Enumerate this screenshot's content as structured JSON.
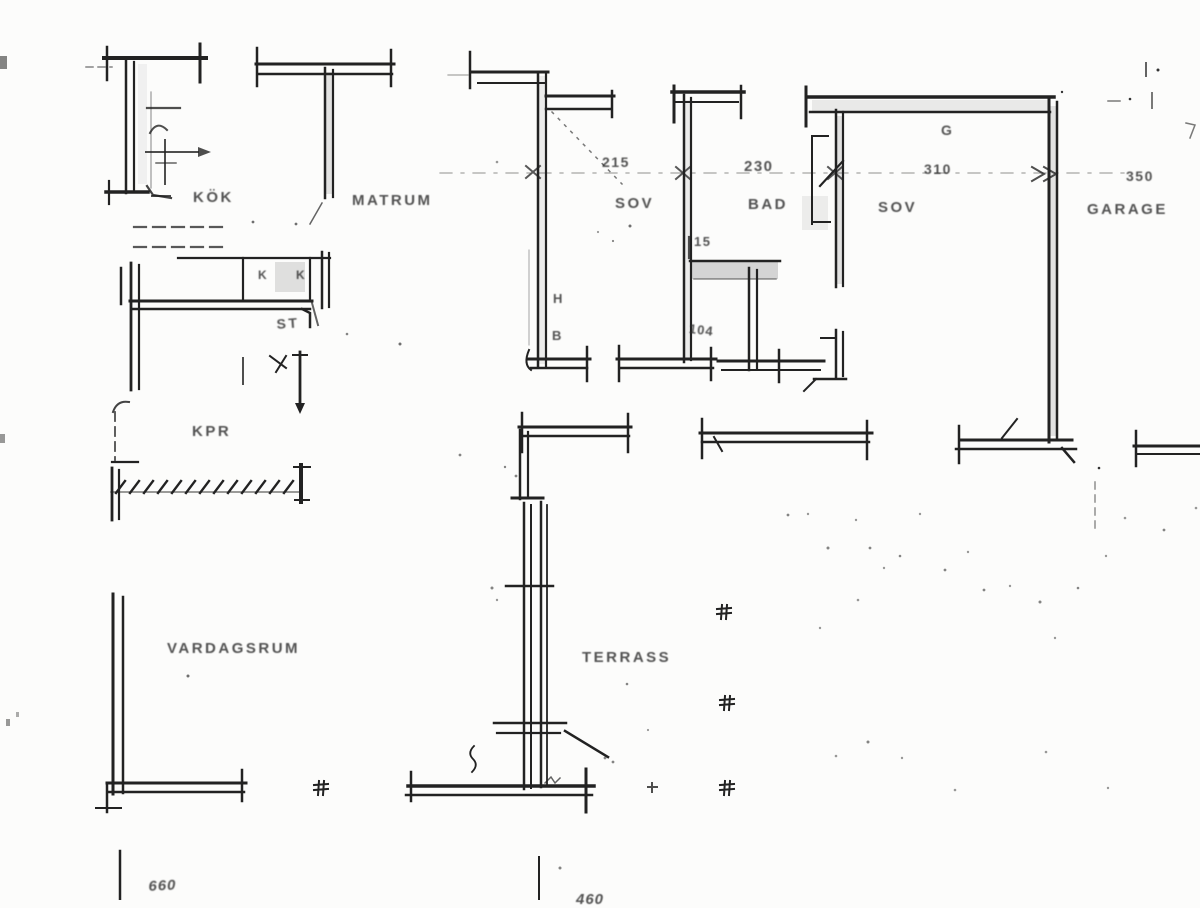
{
  "rooms": {
    "kok": {
      "label": "KÖK"
    },
    "matrum": {
      "label": "MATRUM"
    },
    "sov1": {
      "label": "SOV"
    },
    "bad": {
      "label": "BAD"
    },
    "sov2": {
      "label": "SOV"
    },
    "garage": {
      "label": "GARAGE"
    },
    "kpr": {
      "label": "KPR"
    },
    "st": {
      "label": "ST"
    },
    "vardagsrum": {
      "label": "VARDAGSRUM"
    },
    "terrass": {
      "label": "TERRASS"
    }
  },
  "small_labels": {
    "g": {
      "label": "G"
    },
    "h": {
      "label": "H"
    },
    "b": {
      "label": "B"
    },
    "k1": {
      "label": "K"
    },
    "k2": {
      "label": "K"
    }
  },
  "dimensions": {
    "sov1_width": "215",
    "bad_width": "230",
    "sov2_width": "310",
    "garage_width": "350",
    "bath_door": "15",
    "hall_door": "104",
    "bottom_left": "660",
    "bottom_mid": "460"
  },
  "colors": {
    "ink": "#222222",
    "paper": "#fcfcfb",
    "shade": "#c7c7c7"
  }
}
